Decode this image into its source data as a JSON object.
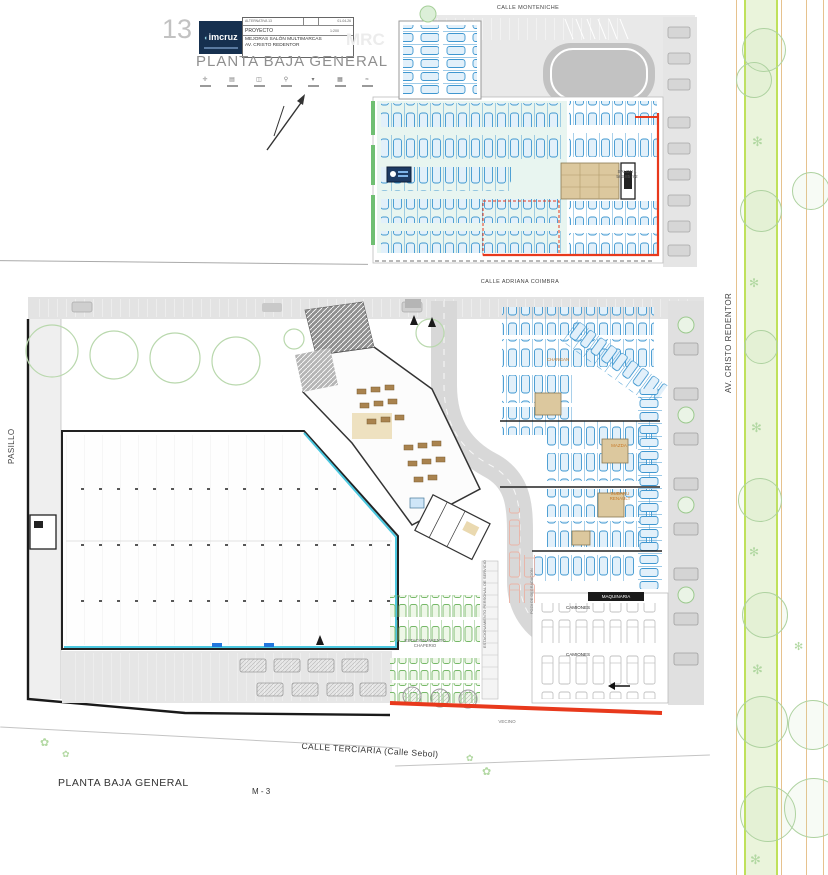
{
  "colors": {
    "parking_blue": "#3f97d0",
    "boundary_red": "#e8391c",
    "median_lime": "#bfe15b",
    "logo_navy": "#16304f",
    "furniture_tan": "#dcc89e",
    "accent_cyan": "#4cc8e0",
    "green_cars": "#76b868"
  },
  "title_block": {
    "sheet_number": "13",
    "logo_text": "imcruz",
    "alternativa": "ALTERNATIVA 13",
    "date": "01-04-26",
    "project_label": "PROYECTO",
    "scale": "1:200",
    "project_name_line1": "MEJORAS SALÓN MULTIMARCAS",
    "project_name_line2": "AV. CRISTO REDENTOR",
    "watermark": "MRC",
    "drawing_title": "PLANTA BAJA GENERAL",
    "legend_icons": [
      {
        "name": "legend-symbol-1",
        "glyph": "✛"
      },
      {
        "name": "legend-symbol-2",
        "glyph": "▤"
      },
      {
        "name": "legend-symbol-3",
        "glyph": "◫"
      },
      {
        "name": "legend-symbol-4",
        "glyph": "⚲"
      },
      {
        "name": "legend-symbol-5",
        "glyph": "▾"
      },
      {
        "name": "legend-symbol-6",
        "glyph": "▦"
      },
      {
        "name": "legend-symbol-7",
        "glyph": "≈"
      }
    ]
  },
  "streets": {
    "top": "CALLE MONTENICHE",
    "middle": "CALLE ADRIANA COIMBRA",
    "right": "AV. CRISTO REDENTOR",
    "left": "PASILLO",
    "bottom": "CALLE TERCIARIA (Calle Sebol)"
  },
  "upper_plan": {
    "salon_name": "SALON 1",
    "salon_area": "583.85 m2"
  },
  "lower_plan": {
    "brand_changan": "CHANGAN",
    "brand_mazda": "MAZDA",
    "brand_subaru": "SUBARU",
    "brand_renault": "RENAULT",
    "maquinaria": "MAQUINARIA",
    "camiones_a": "CAMIONES",
    "camiones_b": "CAMIONES",
    "chaperio_line1": "ESTACIONAMIENTO",
    "chaperio_line2": "CHAPERIO",
    "personal_servicio": "ESTACIONAMIENTO PERSONAL DE SERVICIO",
    "poza": "POZA DE DEGRADACION",
    "vecino": "VECINO"
  },
  "footer": {
    "plan_caption": "PLANTA BAJA GENERAL",
    "sheet_ref": "M - 3"
  }
}
